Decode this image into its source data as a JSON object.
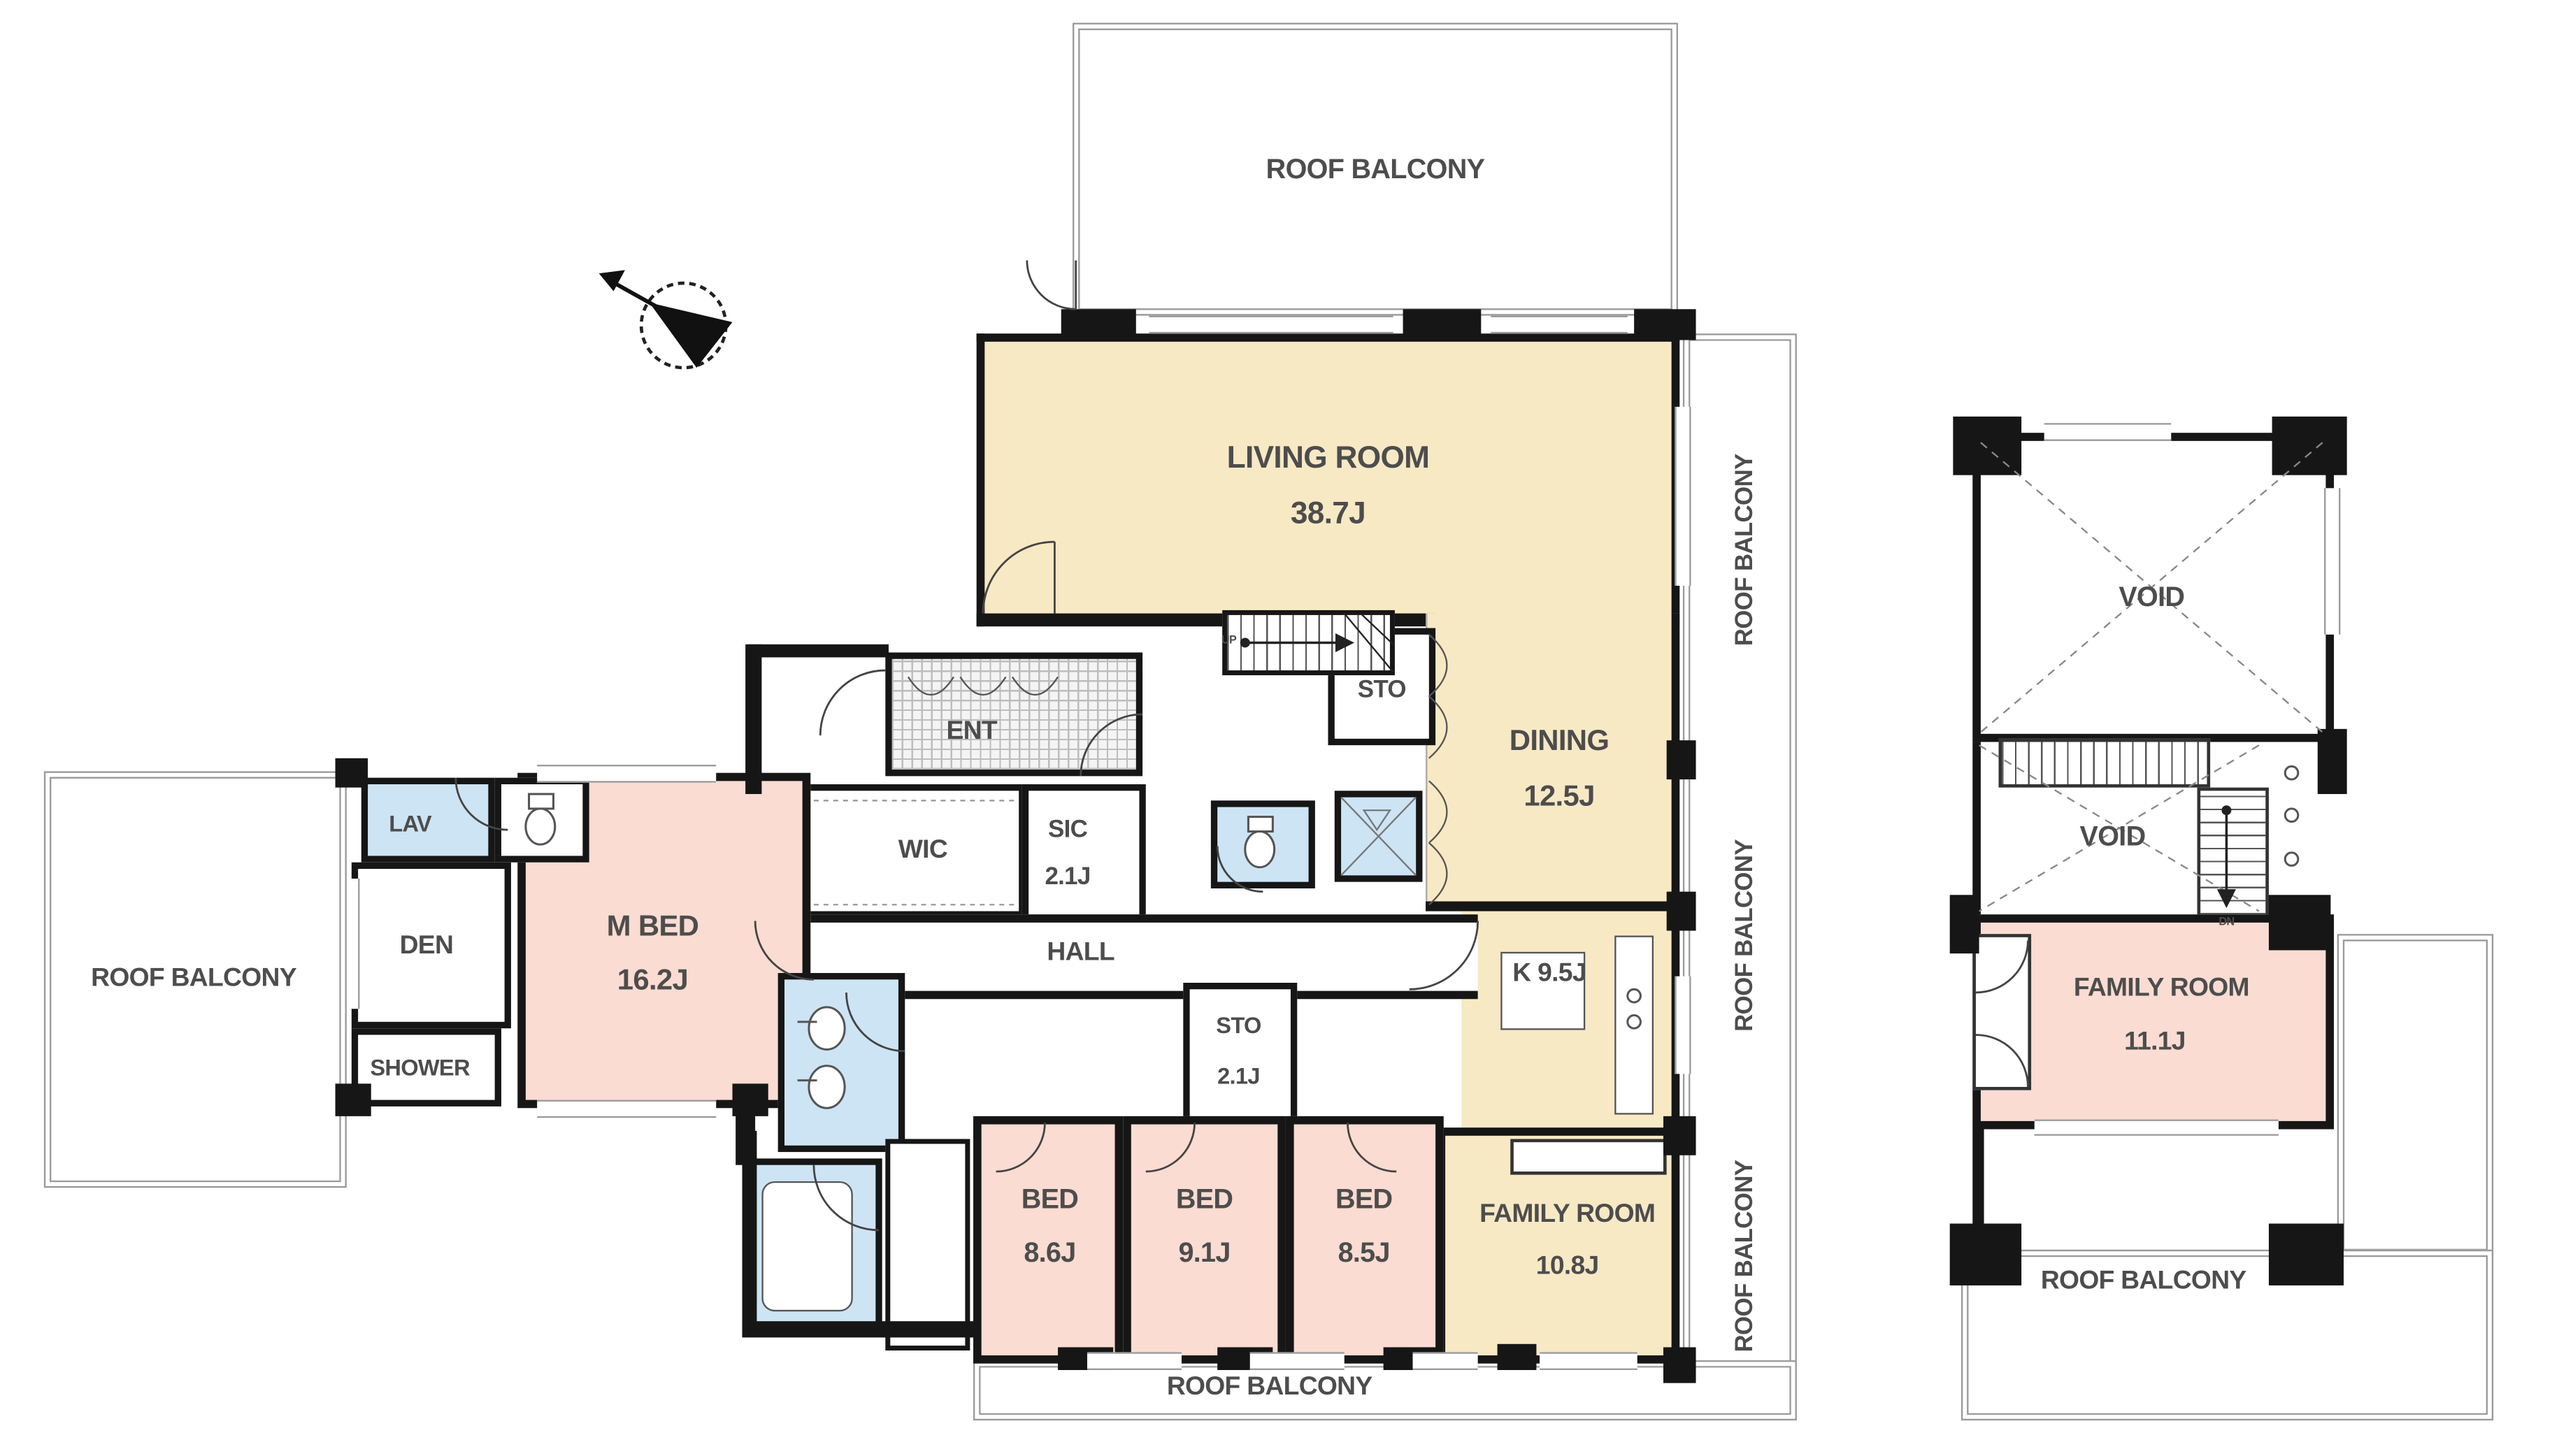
{
  "balcony_label": "ROOF BALCONY",
  "rooms": {
    "living": {
      "name": "LIVING ROOM",
      "area": "38.7J"
    },
    "dining": {
      "name": "DINING",
      "area": "12.5J"
    },
    "kitchen": {
      "name": "K 9.5J"
    },
    "sto_upper": {
      "name": "STO"
    },
    "family": {
      "name": "FAMILY ROOM",
      "area": "10.8J"
    },
    "ent": {
      "name": "ENT"
    },
    "wic": {
      "name": "WIC"
    },
    "sic": {
      "name": "SIC",
      "area": "2.1J"
    },
    "hall": {
      "name": "HALL"
    },
    "mbed": {
      "name": "M BED",
      "area": "16.2J"
    },
    "lav": {
      "name": "LAV"
    },
    "den": {
      "name": "DEN"
    },
    "shower": {
      "name": "SHOWER"
    },
    "sto_lower": {
      "name": "STO",
      "area": "2.1J"
    },
    "bed1": {
      "name": "BED",
      "area": "8.6J"
    },
    "bed2": {
      "name": "BED",
      "area": "9.1J"
    },
    "bed3": {
      "name": "BED",
      "area": "8.5J"
    },
    "void": {
      "name": "VOID"
    },
    "annex_family": {
      "name": "FAMILY ROOM",
      "area": "11.1J"
    }
  },
  "stairs": {
    "up": "UP",
    "down": "DN"
  },
  "colors": {
    "cream": "#f8e9c5",
    "pink": "#fbdcd2",
    "blue": "#cde4f4",
    "wall": "#161616",
    "text": "#4d4d4d",
    "line": "#9a9a9a"
  }
}
